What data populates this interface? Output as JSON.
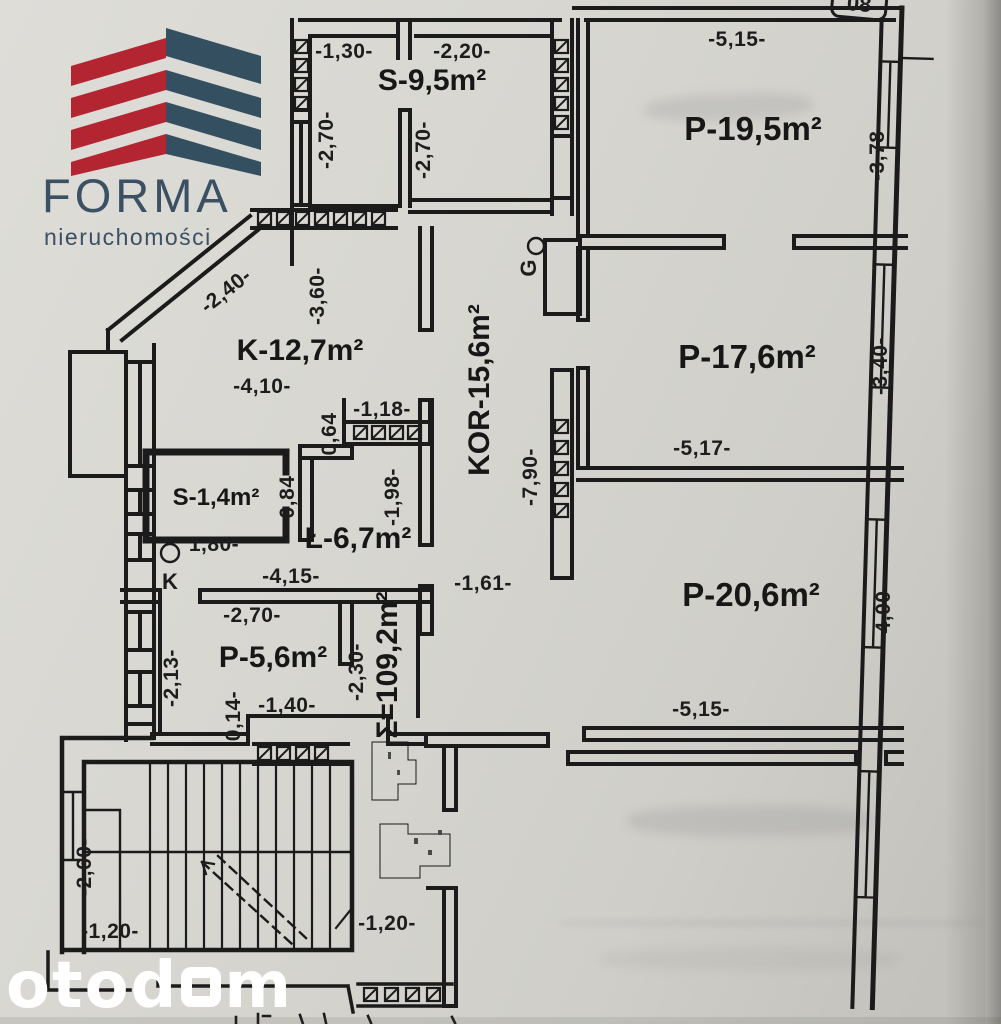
{
  "logo": {
    "brand": "FORMA",
    "tagline": "nieruchomości",
    "red": "#b32531",
    "navy": "#344f60"
  },
  "plan": {
    "unit_badge": "08",
    "total_area": "Σ=109,2m²",
    "corridor_label": "KOR-15,6m²",
    "rooms": {
      "s95": "S-9,5m²",
      "p195": "P-19,5m²",
      "k127": "K-12,7m²",
      "p176": "P-17,6m²",
      "s14": "S-1,4m²",
      "l67": "Ł-6,7m²",
      "p56": "P-5,6m²",
      "p206": "P-20,6m²"
    },
    "symbols": {
      "gas": "G",
      "kitchen": "K"
    },
    "dims": {
      "d130": "-1,30-",
      "d220": "-2,20-",
      "d270a": "-2,70-",
      "d270b": "-2,70-",
      "d515a": "-5,15-",
      "d378": "-3,78-",
      "d240": "-2,40-",
      "d360": "-3,60-",
      "d410": "-4,10-",
      "d118": "-1,18-",
      "d064": "0,64",
      "d790": "-7,90-",
      "d161": "-1,61-",
      "d517": "-5,17-",
      "d340": "-3,40-",
      "d084": "-0,84-",
      "d198": "-1,98-",
      "d180": "1,80-",
      "d415": "-4,15-",
      "d270c": "-2,70-",
      "d213": "-2,13-",
      "d014": "0,14-",
      "d140": "-1,40-",
      "d230": "-2,30-",
      "d515b": "-5,15-",
      "d400": "-4,00-",
      "d260": "-2,60-",
      "d120a": "-1,20-",
      "d120b": "-1,20-"
    }
  },
  "watermark": {
    "full": "otodom",
    "prefix": "otod",
    "suffix": "m"
  }
}
